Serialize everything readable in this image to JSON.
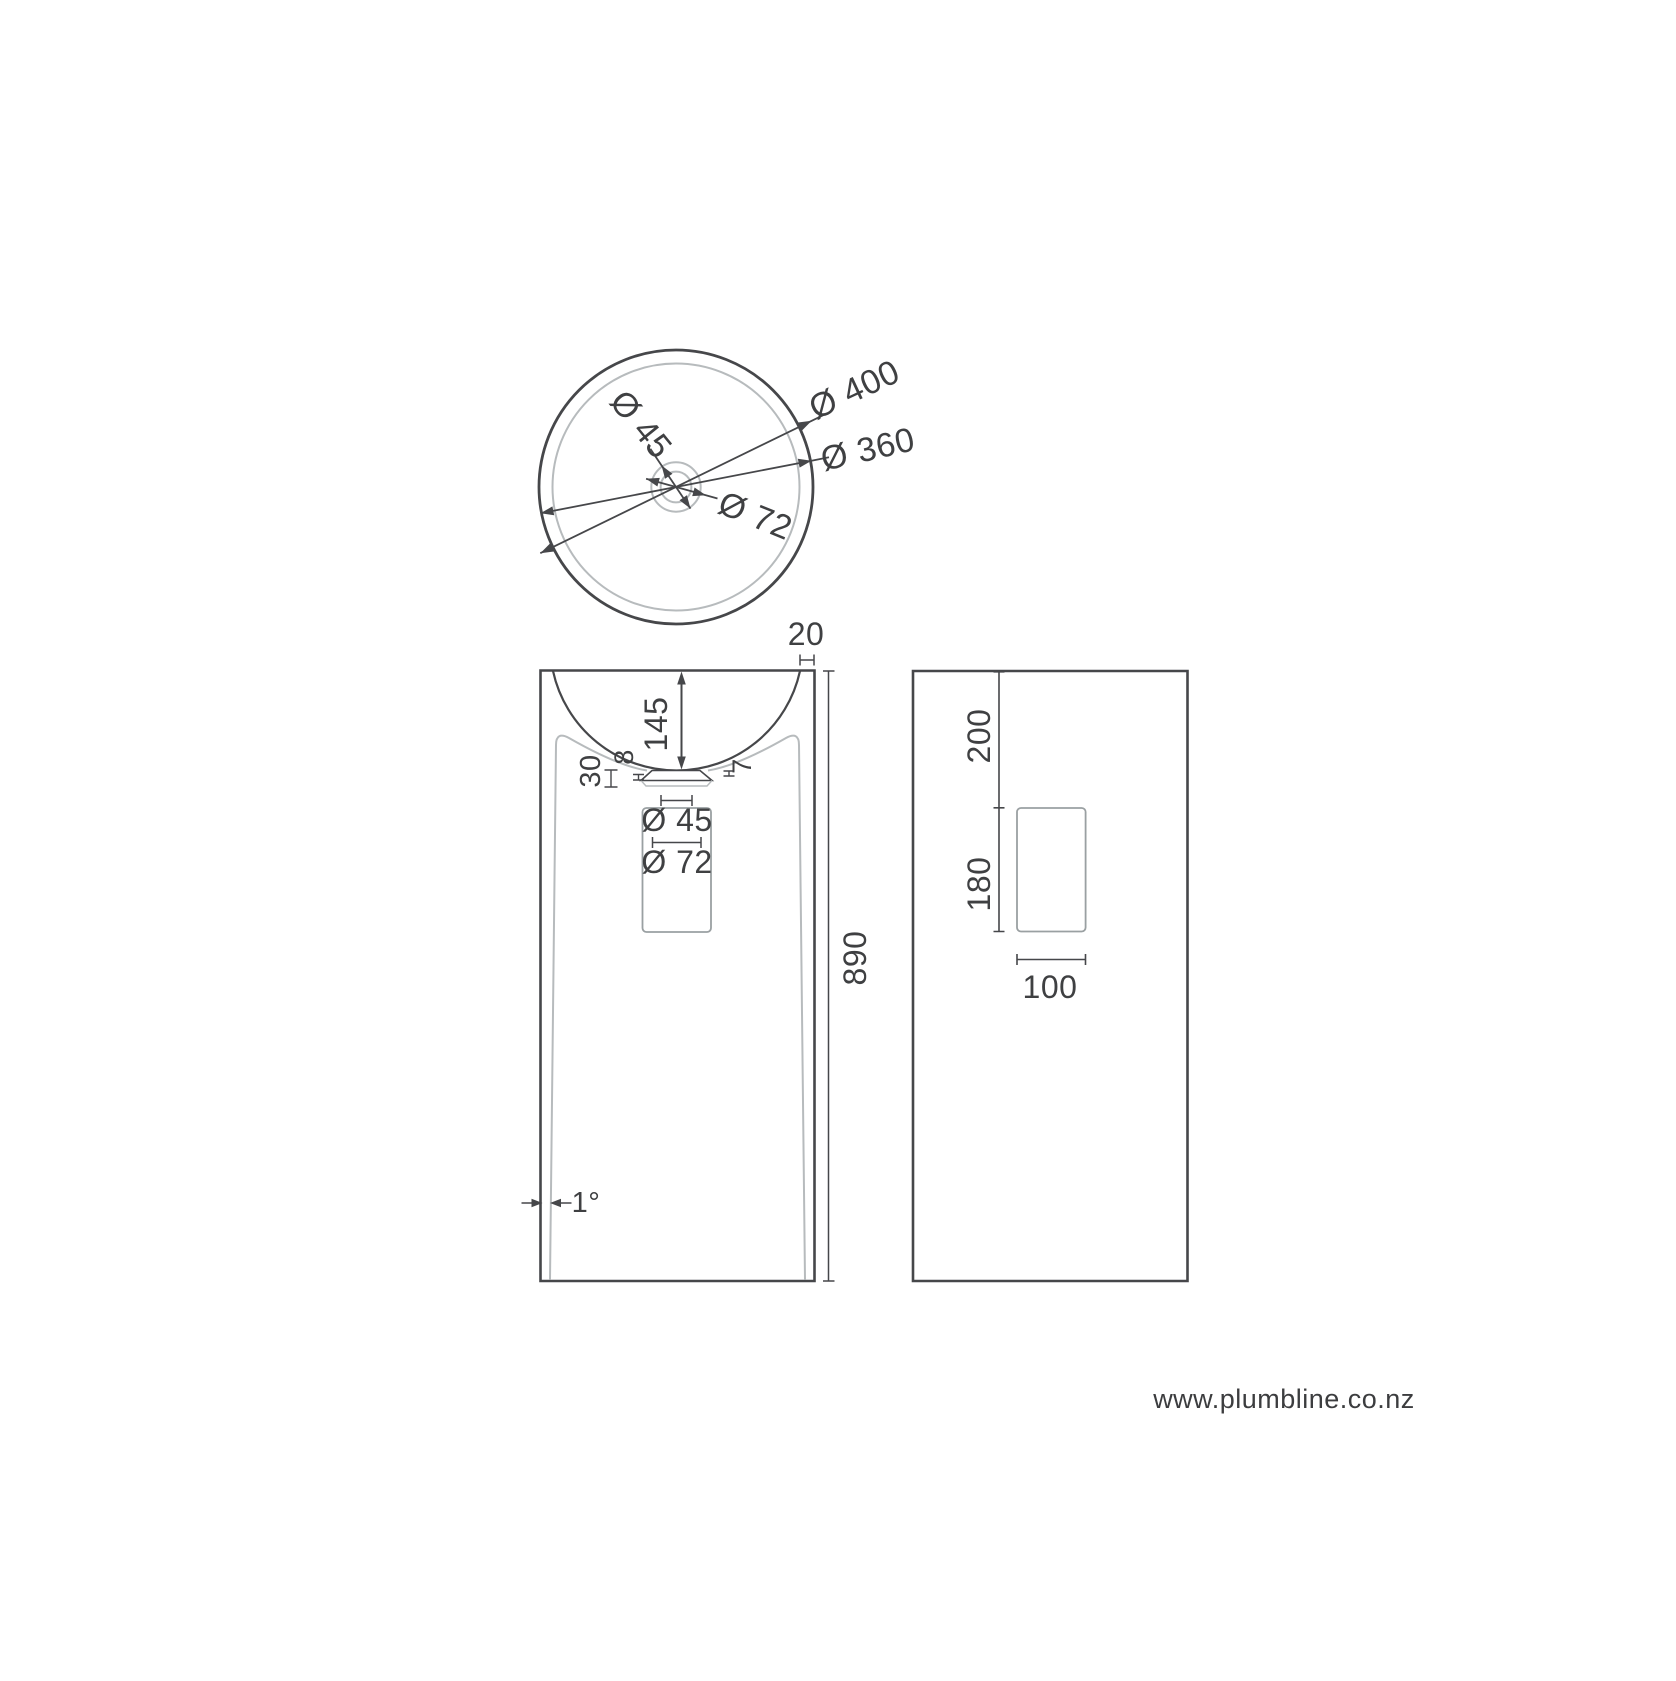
{
  "drawing": {
    "title_note": "pedestal basin dimension drawing",
    "top_view": {
      "outer_diameter": "Ø 400",
      "basin_diameter": "Ø 360",
      "drain_inner_diameter": "Ø 45",
      "drain_outer_diameter": "Ø 72"
    },
    "front_view": {
      "rim_thickness": "20",
      "basin_depth": "145",
      "underbowl_gap": "30",
      "flange_step_left": "8",
      "flange_step_right": "7",
      "waste_inner_diameter": "Ø 45",
      "waste_outer_diameter": "Ø 72",
      "overall_height": "890",
      "wall_taper_angle": "1°"
    },
    "side_view": {
      "top_to_recess": "200",
      "recess_height": "180",
      "recess_width": "100"
    },
    "colors": {
      "background": "#ffffff",
      "line_dark": "#46474a",
      "line_light": "#b7bbbd",
      "line_mid": "#9aa0a2",
      "text": "#3f4042"
    }
  },
  "footer": {
    "url": "www.plumbline.co.nz"
  }
}
